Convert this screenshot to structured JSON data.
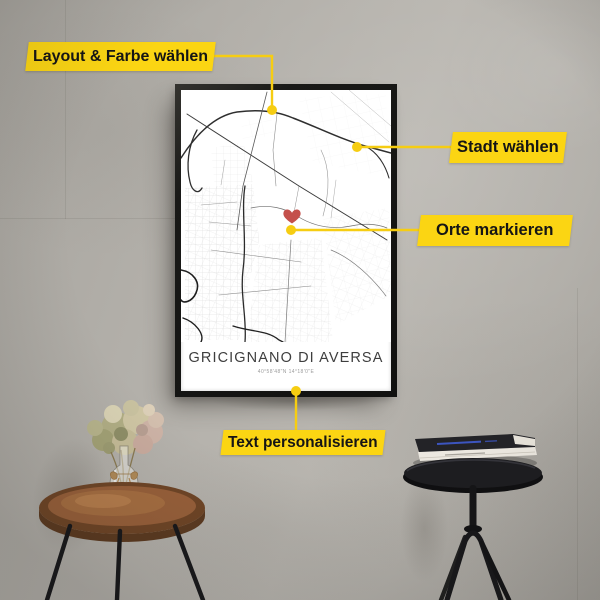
{
  "scene": {
    "wall_color": "#b2afa9",
    "accent_yellow": "#FBD513"
  },
  "annotations": {
    "layout_label": "Layout & Farbe wählen",
    "stadt_label": "Stadt wählen",
    "orte_label": "Orte markieren",
    "text_label": "Text personalisieren"
  },
  "poster": {
    "title": "GRICIGNANO DI AVERSA",
    "coordinates": "40°58'48\"N 14°18'0\"E",
    "marker_color": "#C4504B",
    "frame_color": "#191917",
    "map_bg": "#ffffff"
  },
  "props": {
    "side_table_wood_color": "#8a5430",
    "stool_color": "#1b1b1d",
    "book_top_color": "#232327",
    "book_bottom_color": "#ece8e0"
  }
}
